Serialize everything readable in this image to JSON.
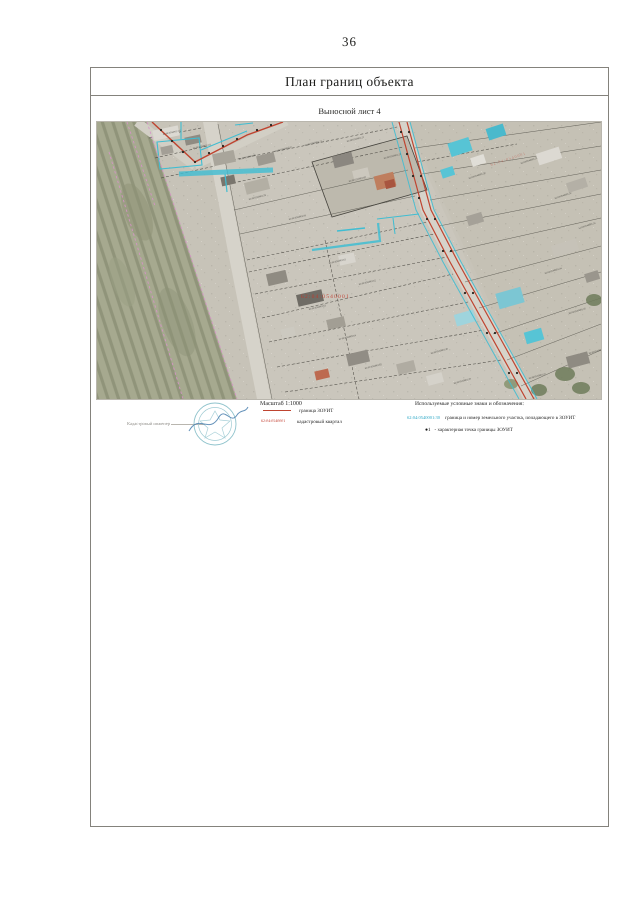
{
  "page_number": "36",
  "header": {
    "title": "План границ объекта"
  },
  "sheet": {
    "label": "Выносной лист 4"
  },
  "map": {
    "quarter_label": "62:04:0540001",
    "quarter_label_faint": "62:04:0540001",
    "parcel_labels": [
      {
        "text": "62:04:0540001:112",
        "x": 66,
        "y": 13,
        "angle": -12
      },
      {
        "text": "62:04:0540001:113",
        "x": 96,
        "y": 27,
        "angle": -12
      },
      {
        "text": "62:04:0540001:96",
        "x": 142,
        "y": 38,
        "angle": -14
      },
      {
        "text": "62:04:0540001:97",
        "x": 178,
        "y": 30,
        "angle": -14
      },
      {
        "text": "62:04:0540001:21",
        "x": 208,
        "y": 24,
        "angle": -14
      },
      {
        "text": "62:04:0540001:22",
        "x": 250,
        "y": 20,
        "angle": -14
      },
      {
        "text": "62:04:0540001:23",
        "x": 287,
        "y": 37,
        "angle": -14
      },
      {
        "text": "62:04:0540001:58",
        "x": 152,
        "y": 78,
        "angle": -14
      },
      {
        "text": "62:04:0540001:59",
        "x": 192,
        "y": 98,
        "angle": -13
      },
      {
        "text": "62:04:0540001:60",
        "x": 252,
        "y": 60,
        "angle": -14
      },
      {
        "text": "62:04:0540001:61",
        "x": 232,
        "y": 142,
        "angle": -13
      },
      {
        "text": "62:04:0540001:62",
        "x": 262,
        "y": 163,
        "angle": -13
      },
      {
        "text": "62:04:0540001:63",
        "x": 212,
        "y": 188,
        "angle": -13
      },
      {
        "text": "62:04:0540001:64",
        "x": 242,
        "y": 218,
        "angle": -13
      },
      {
        "text": "62:04:0540001:65",
        "x": 268,
        "y": 247,
        "angle": -13
      },
      {
        "text": "62:04:0540001:30",
        "x": 372,
        "y": 57,
        "angle": -18
      },
      {
        "text": "62:04:0540001:31",
        "x": 424,
        "y": 42,
        "angle": -18
      },
      {
        "text": "62:04:0540001:32",
        "x": 458,
        "y": 77,
        "angle": -18
      },
      {
        "text": "62:04:0540001:33",
        "x": 482,
        "y": 107,
        "angle": -18
      },
      {
        "text": "62:04:0540001:34",
        "x": 448,
        "y": 152,
        "angle": -17
      },
      {
        "text": "62:04:0540001:35",
        "x": 472,
        "y": 192,
        "angle": -16
      },
      {
        "text": "62:04:0540001:36",
        "x": 492,
        "y": 232,
        "angle": -15
      },
      {
        "text": "62:04:0540001:37",
        "x": 432,
        "y": 257,
        "angle": -15
      },
      {
        "text": "62:04:0540001:38",
        "x": 334,
        "y": 232,
        "angle": -15
      },
      {
        "text": "62:04:0540001:39",
        "x": 357,
        "y": 262,
        "angle": -15
      }
    ]
  },
  "legend": {
    "scale_label": "Масштаб  1:1000",
    "engineer_label": "Кадастровый инженер",
    "middle_items": [
      {
        "label": "граница ЗОУИТ"
      },
      {
        "swatch_text": "62:04:0540001",
        "label": "кадастровый квартал"
      }
    ],
    "right": {
      "header": "Используемые условные знаки и обозначения:",
      "items": [
        {
          "swatch_text": "62:04:0540001:30",
          "label": "граница и номер земельного участка, попадающего в ЗОУИТ"
        },
        {
          "marker": "●",
          "marker_num": "1",
          "label": "- характерная точка границы ЗОУИТ"
        }
      ]
    }
  },
  "colors": {
    "zouit_boundary": "#bf4430",
    "parcel_in_zouit": "#3fbdd2",
    "cadastral_quarter": "#c0392b",
    "field_boundary": "#d791c9"
  }
}
